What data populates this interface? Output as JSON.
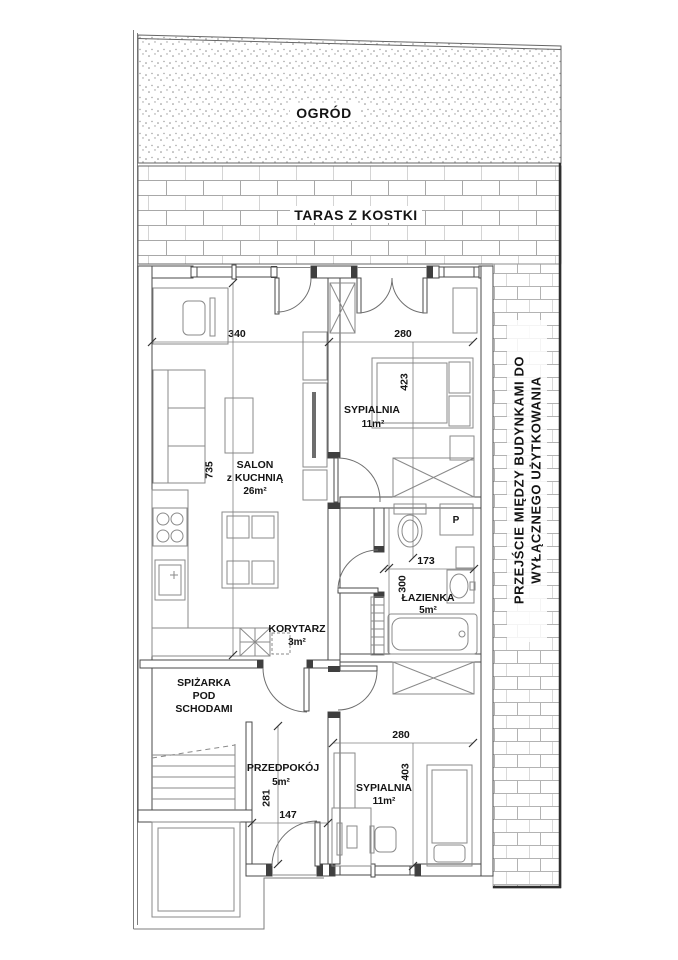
{
  "site": {
    "garden_label": "OGRÓD",
    "terrace_label": "TARAS Z KOSTKI",
    "passage_label_line1": "PRZEJŚCIE MIĘDZY BUDYNKAMI DO",
    "passage_label_line2": "WYŁĄCZNEGO UŻYTKOWANIA"
  },
  "rooms": {
    "salon": {
      "line1": "SALON",
      "line2": "z KUCHNIĄ",
      "area": "26m²"
    },
    "bedroom_top": {
      "name": "SYPIALNIA",
      "area": "11m²"
    },
    "bathroom": {
      "name": "ŁAZIENKA",
      "area": "5m²"
    },
    "corridor": {
      "name": "KORYTARZ",
      "area": "3m²"
    },
    "pantry": {
      "line1": "SPIŻARKA",
      "line2": "POD",
      "line3": "SCHODAMI"
    },
    "hall": {
      "name": "PRZEDPOKÓJ",
      "area": "5m²"
    },
    "bedroom_bottom": {
      "name": "SYPIALNIA",
      "area": "11m²"
    }
  },
  "dimensions": {
    "salon_width": "340",
    "salon_height": "735",
    "bedroom_top_width": "280",
    "bedroom_top_height": "423",
    "bathroom_width": "173",
    "bathroom_height": "300",
    "bedroom_bottom_width": "280",
    "bedroom_bottom_height": "403",
    "hall_height": "281",
    "hall_width": "147"
  },
  "fixtures": {
    "washer_label": "P"
  },
  "colors": {
    "line": "#4a4a4a",
    "brick": "#a8a8a8",
    "text": "#141414",
    "background": "#ffffff"
  }
}
